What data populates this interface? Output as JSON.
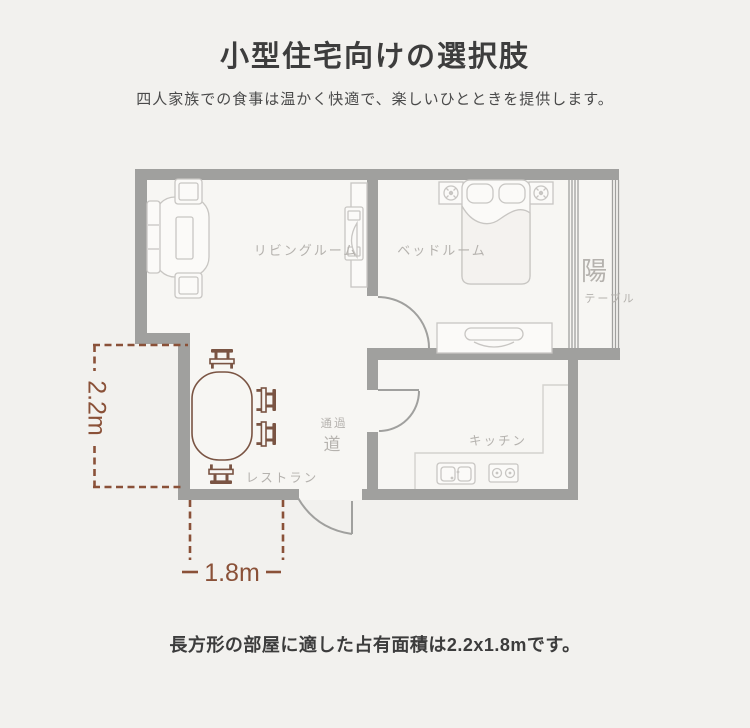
{
  "header": {
    "title": "小型住宅向けの選択肢",
    "subtitle": "四人家族での食事は温かく快適で、楽しいひとときを提供します。"
  },
  "floorplan": {
    "rooms": {
      "living": "リビングルーム",
      "bedroom": "ベッドルーム",
      "kitchen": "キッチン",
      "dining": "レストラン",
      "hallway_top": "通過",
      "hallway_main": "道",
      "balcony_main": "陽",
      "balcony_sub": "テーブル"
    },
    "dimensions": {
      "vertical": "2.2m",
      "horizontal": "1.8m"
    },
    "colors": {
      "wall": "#a0a09e",
      "furniture_line": "#c8c6c3",
      "accent_brown": "#8a5138",
      "table_brown": "#7a5443",
      "room_fill": "#f7f6f3",
      "label_gray": "#b5b2ae",
      "background": "#f2f1ee"
    }
  },
  "footer": {
    "caption": "長方形の部屋に適した占有面積は2.2x1.8mです。"
  }
}
